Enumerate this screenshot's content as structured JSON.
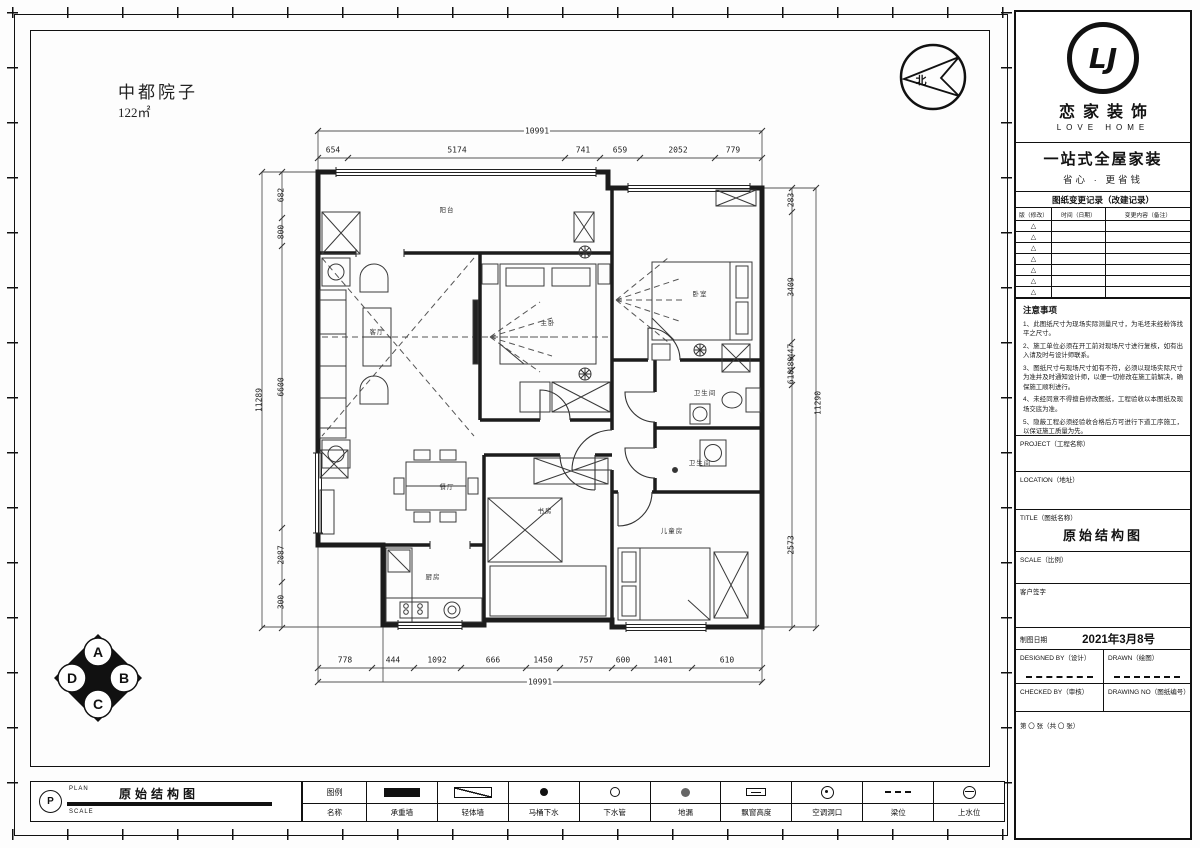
{
  "sheet": {
    "project_name": "中都院子",
    "project_area": "122㎡",
    "compass_label": "北",
    "elevation_marks": [
      "A",
      "B",
      "C",
      "D"
    ],
    "rooms": [
      {
        "name": "阳台"
      },
      {
        "name": "客厅"
      },
      {
        "name": "餐厅"
      },
      {
        "name": "厨房"
      },
      {
        "name": "主卧"
      },
      {
        "name": "卧室"
      },
      {
        "name": "卫生间"
      },
      {
        "name": "卫生间"
      },
      {
        "name": "书房"
      },
      {
        "name": "儿童房"
      }
    ],
    "dims": {
      "top_total": "10991",
      "top": [
        "654",
        "5174",
        "741",
        "659",
        "2052",
        "779"
      ],
      "bottom": [
        "778",
        "444",
        "1092",
        "666",
        "1450",
        "757",
        "600",
        "1401",
        "610"
      ],
      "bottom_total": "10991",
      "left": [
        "682",
        "800",
        "6600",
        "2087",
        "300"
      ],
      "left_total": "11289",
      "right": [
        "283",
        "3409",
        "447",
        "489",
        "610",
        "2573"
      ],
      "right_total": "11290"
    }
  },
  "footer": {
    "stamp": "P",
    "plan_label": "PLAN",
    "scale_label": "SCALE",
    "drawing_title": "原始结构图"
  },
  "legend": {
    "header_top": "图例",
    "header_bottom": "名称",
    "items": [
      {
        "symbol": "solid-wall",
        "label": "承重墙"
      },
      {
        "symbol": "hatch-wall",
        "label": "轻体墙"
      },
      {
        "symbol": "filled-dot",
        "label": "马桶下水"
      },
      {
        "symbol": "open-dot",
        "label": "下水管"
      },
      {
        "symbol": "gray-dot",
        "label": "地漏"
      },
      {
        "symbol": "bay-window",
        "label": "飘窗高度"
      },
      {
        "symbol": "ac-opening",
        "label": "空调洞口"
      },
      {
        "symbol": "beam",
        "label": "梁位"
      },
      {
        "symbol": "water-supply",
        "label": "上水位"
      }
    ]
  },
  "brand": {
    "monogram": "LJ",
    "name": "恋家装饰",
    "name_en": "LOVE HOME",
    "tagline": "一站式全屋家装",
    "slogan": "省心 · 更省钱"
  },
  "revisions": {
    "title": "图纸变更记录（改建记录）",
    "col_rev": "版（修改）",
    "col_date": "时间（日期）",
    "col_desc": "变更内容（备注）",
    "marker": "△"
  },
  "notes": {
    "title": "注意事项",
    "items": [
      "1、此图纸尺寸为现场实际测量尺寸，为毛坯未经粉饰找平之尺寸。",
      "2、施工单位必须在开工前对现场尺寸进行复核，如有出入请及时与设计师联系。",
      "3、图纸尺寸与现场尺寸如有不符，必须以现场实际尺寸为准并及时通知设计师，以便一切修改在施工前解决，确保施工顺利进行。",
      "4、未经同意不得擅自修改图纸，工程验收以本图纸及现场交底为准。",
      "5、隐蔽工程必须经验收合格后方可进行下道工序施工，以保证施工质量为先。",
      "6、本图所注尺寸单位为毫米。"
    ]
  },
  "titleblock": {
    "project_label": "PROJECT（工程名称）",
    "location_label": "LOCATION（地址）",
    "title_label": "TITLE（图纸名称）",
    "title_value": "原始结构图",
    "scale_label": "SCALE（比例）",
    "sign_label": "客户签字",
    "date_label": "制图日期",
    "date_value": "2021年3月8号",
    "designed_label": "DESIGNED BY（设计）",
    "drawn_label": "DRAWN（绘图）",
    "checked_label": "CHECKED BY（审核）",
    "number_label": "DRAWING NO（图纸编号）",
    "sheet_label": "第 〇 张（共 〇 张）"
  }
}
